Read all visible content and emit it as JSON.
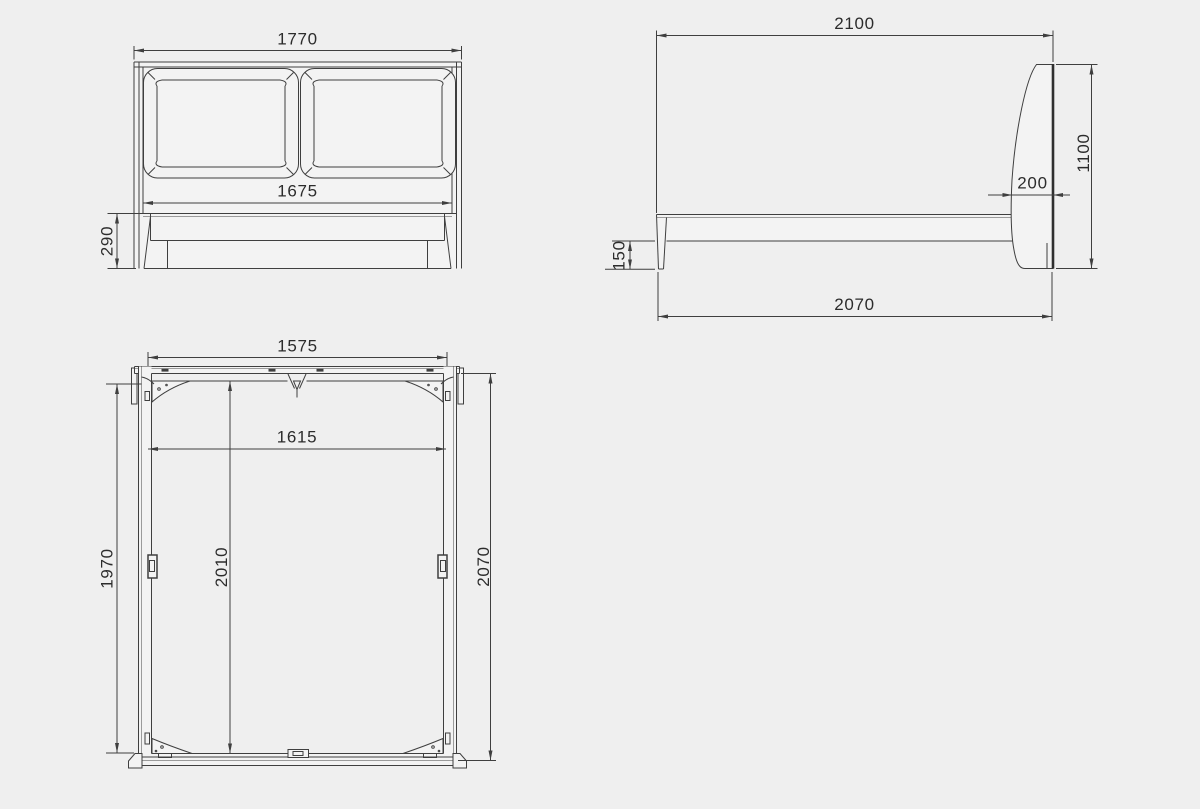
{
  "drawing": {
    "type": "furniture technical drawing (bed frame, three orthographic views)",
    "colors": {
      "background": "#efefef",
      "part_fill": "#f3f3f3",
      "line": "#3f3f3f",
      "line_light": "#9b9b9b",
      "text": "#2c2c2c"
    },
    "dims": {
      "front": {
        "overall_width": "1770",
        "inner_width": "1675",
        "rail_height": "290"
      },
      "side": {
        "overall_length": "2100",
        "headboard_height": "1100",
        "headboard_thickness": "200",
        "frame_clearance": "150",
        "base_length": "2070"
      },
      "plan": {
        "headboard_width": "1575",
        "inner_width": "1615",
        "left_length": "1970",
        "inner_length": "2010",
        "overall_length": "2070"
      }
    }
  }
}
